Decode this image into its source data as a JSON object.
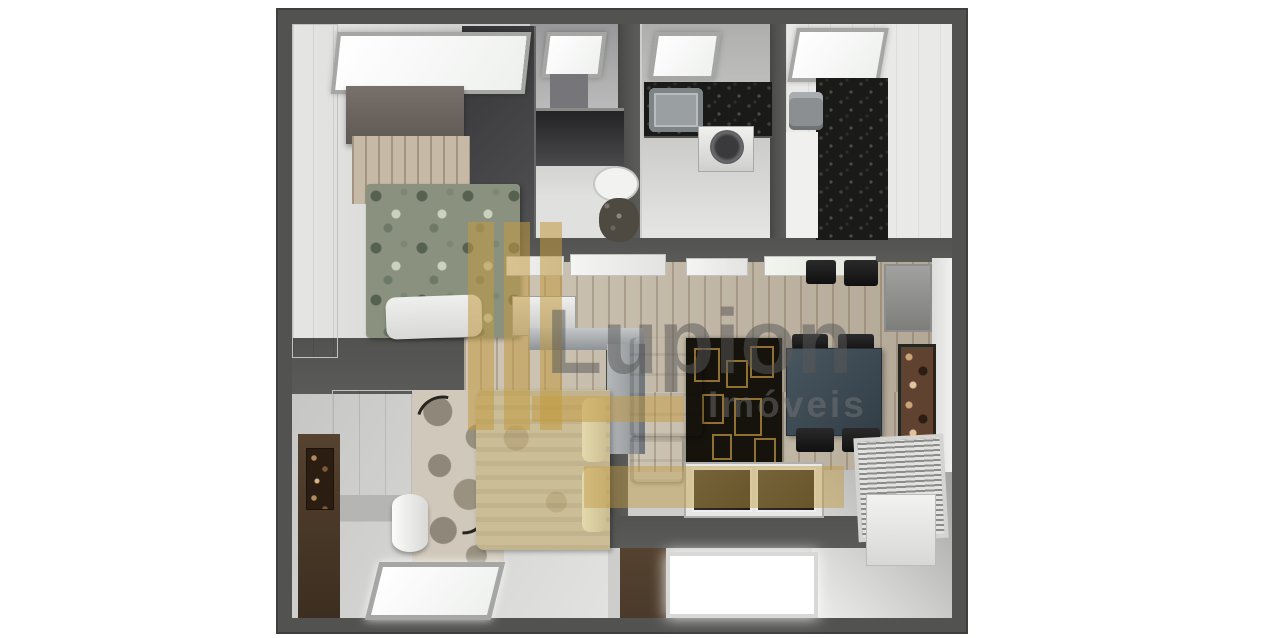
{
  "scene": {
    "description": "3D top-down render of a small apartment floor plan (bedrooms, bathrooms, kitchen, living-dining room and balcony)"
  },
  "watermark": {
    "brand": "Lupion",
    "tagline": "Imóveis"
  },
  "palette": {
    "wall": "#525250",
    "wall-edge": "#3f3f3d",
    "wood": "#c6baa6",
    "granite": "#1a1a18",
    "floral": "#8a927f",
    "bed-beige": "#cbbd96",
    "sofa-cream": "#ddd3b8",
    "rug-black": "#16130d",
    "rug-gold": "#9c7b3c",
    "table-slate": "#3e4b55",
    "chair-black": "#1e1e1e",
    "panel-brown": "#4a3a2c",
    "watermark-gold": "#c19a40",
    "watermark-gray": "#585858",
    "background": "#ffffff"
  }
}
